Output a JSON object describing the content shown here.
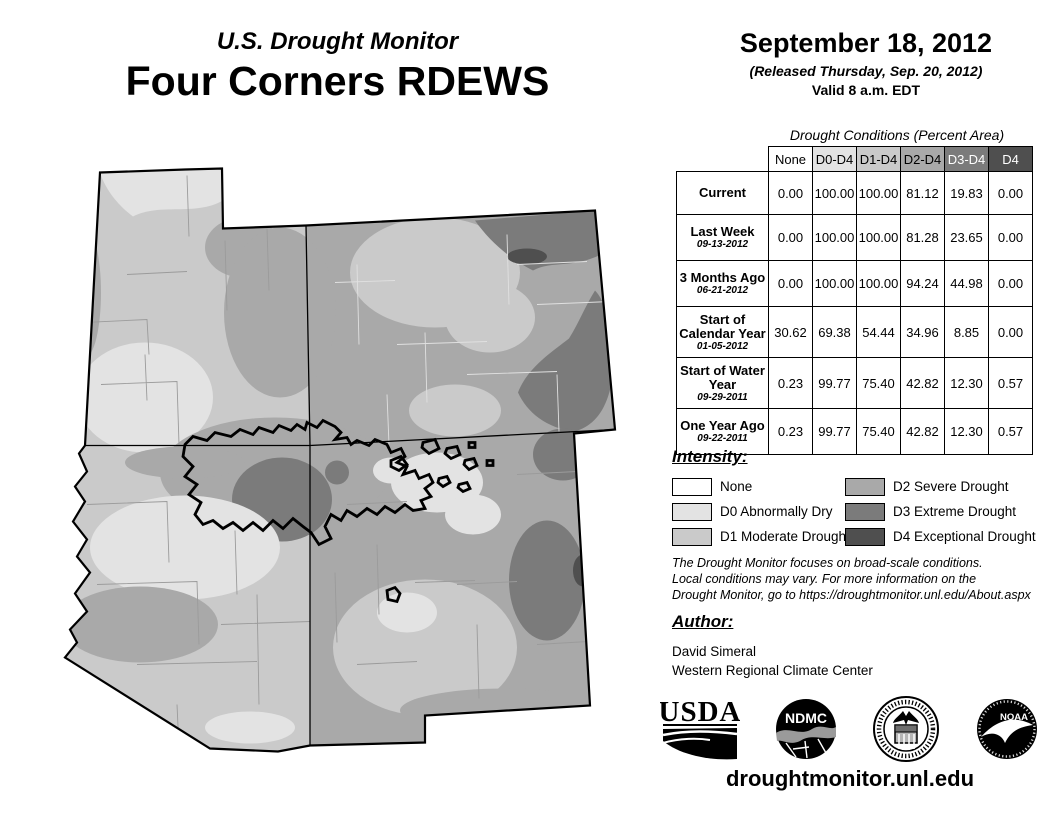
{
  "header": {
    "supertitle": "U.S. Drought Monitor",
    "title": "Four Corners RDEWS",
    "date": "September 18, 2012",
    "released": "(Released Thursday, Sep. 20, 2012)",
    "valid": "Valid 8 a.m. EDT"
  },
  "table": {
    "caption": "Drought Conditions (Percent Area)",
    "columns": [
      "None",
      "D0-D4",
      "D1-D4",
      "D2-D4",
      "D3-D4",
      "D4"
    ],
    "rows": [
      {
        "label": "Current",
        "sublabel": "",
        "values": [
          "0.00",
          "100.00",
          "100.00",
          "81.12",
          "19.83",
          "0.00"
        ]
      },
      {
        "label": "Last Week",
        "sublabel": "09-13-2012",
        "values": [
          "0.00",
          "100.00",
          "100.00",
          "81.28",
          "23.65",
          "0.00"
        ]
      },
      {
        "label": "3 Months Ago",
        "sublabel": "06-21-2012",
        "values": [
          "0.00",
          "100.00",
          "100.00",
          "94.24",
          "44.98",
          "0.00"
        ]
      },
      {
        "label": "Start of Calendar Year",
        "sublabel": "01-05-2012",
        "values": [
          "30.62",
          "69.38",
          "54.44",
          "34.96",
          "8.85",
          "0.00"
        ]
      },
      {
        "label": "Start of Water Year",
        "sublabel": "09-29-2011",
        "values": [
          "0.23",
          "99.77",
          "75.40",
          "42.82",
          "12.30",
          "0.57"
        ]
      },
      {
        "label": "One Year Ago",
        "sublabel": "09-22-2011",
        "values": [
          "0.23",
          "99.77",
          "75.40",
          "42.82",
          "12.30",
          "0.57"
        ]
      }
    ]
  },
  "legend": {
    "heading": "Intensity:",
    "items": [
      {
        "code": "none",
        "label": "None",
        "color": "#FFFFFF"
      },
      {
        "code": "d0",
        "label": "D0 Abnormally Dry",
        "color": "#E3E3E3"
      },
      {
        "code": "d1",
        "label": "D1 Moderate Drought",
        "color": "#CACACA"
      },
      {
        "code": "d2",
        "label": "D2 Severe Drought",
        "color": "#A9A9A9"
      },
      {
        "code": "d3",
        "label": "D3 Extreme Drought",
        "color": "#7B7B7B"
      },
      {
        "code": "d4",
        "label": "D4 Exceptional Drought",
        "color": "#4F4F4F"
      }
    ]
  },
  "notes": {
    "line1": "The Drought Monitor focuses on broad-scale conditions.",
    "line2": "Local conditions may vary. For more information on the",
    "line3": "Drought Monitor, go to https://droughtmonitor.unl.edu/About.aspx"
  },
  "author": {
    "heading": "Author:",
    "name": "David Simeral",
    "org": "Western Regional Climate Center"
  },
  "logos": {
    "usda_label": "USDA",
    "ndmc_label": "NDMC",
    "noaa_label": "NOAA"
  },
  "footer": {
    "url": "droughtmonitor.unl.edu"
  }
}
